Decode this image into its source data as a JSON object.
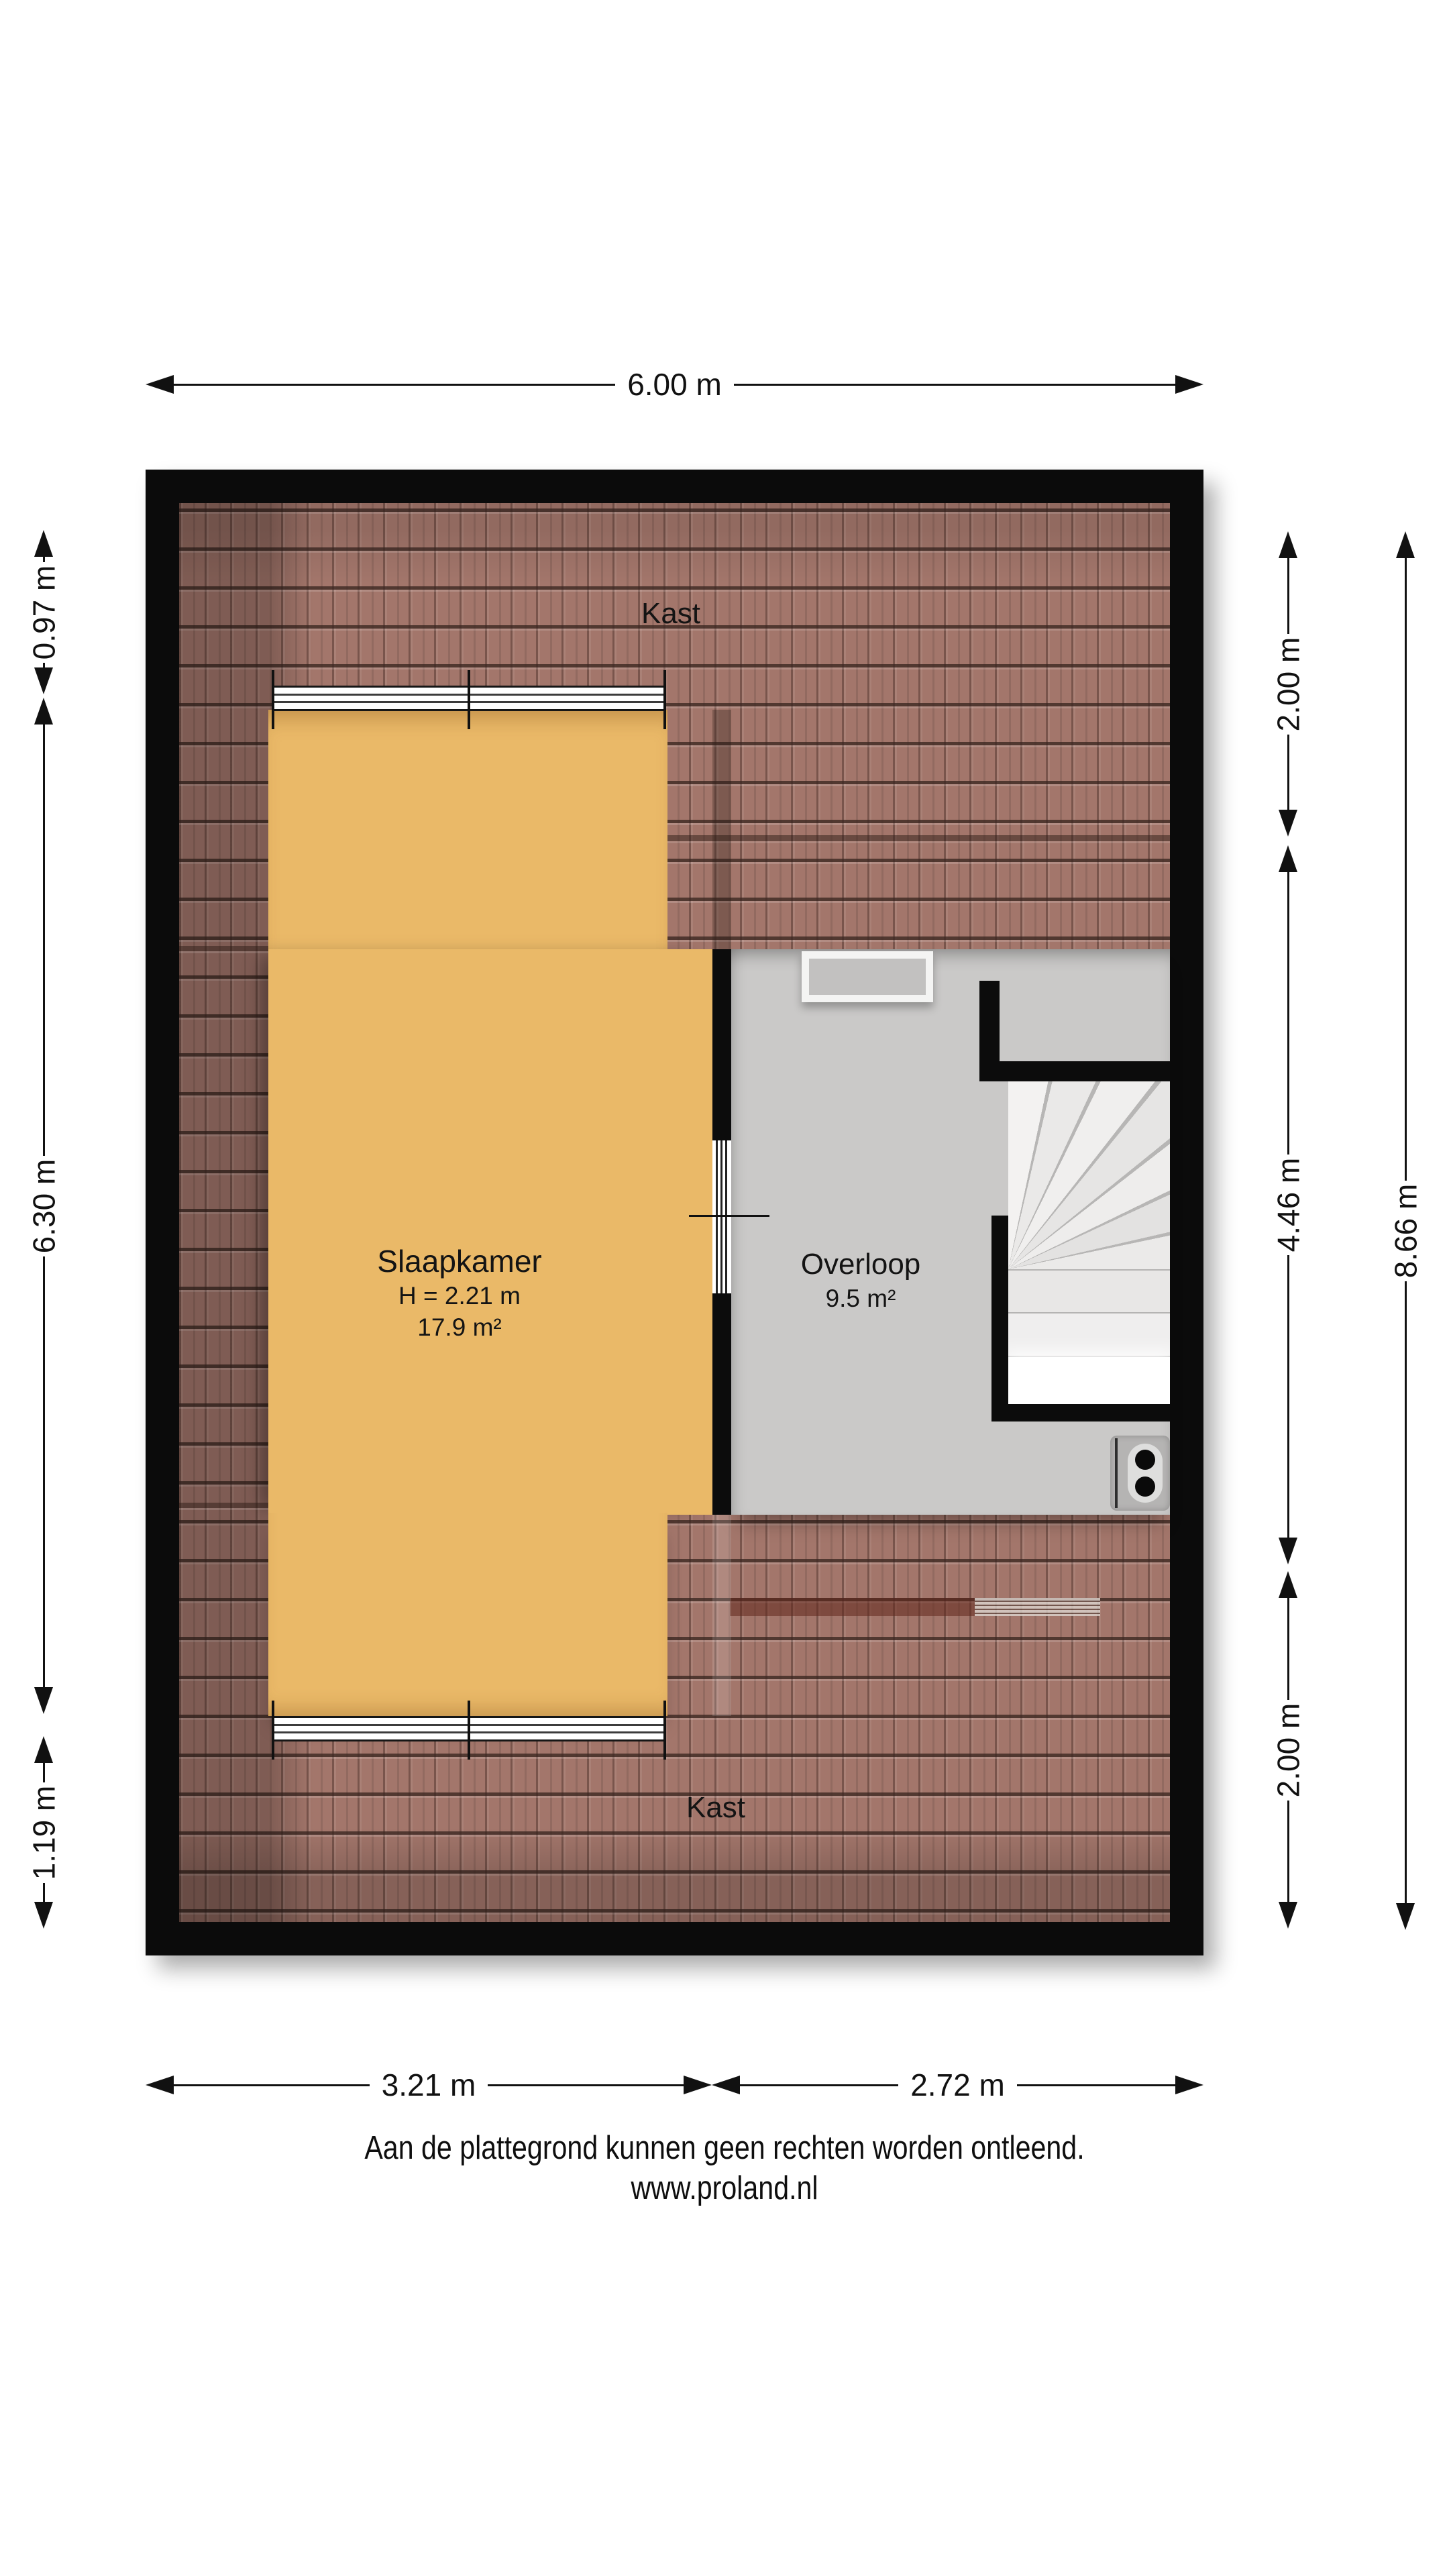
{
  "plan": {
    "rooms": {
      "kast_top": {
        "label": "Kast"
      },
      "slaapkamer": {
        "label": "Slaapkamer",
        "ceiling_height": "H = 2.21 m",
        "area": "17.9 m²"
      },
      "overloop": {
        "label": "Overloop",
        "area": "9.5 m²"
      },
      "kast_bottom": {
        "label": "Kast"
      }
    }
  },
  "dimensions": {
    "top": "6.00 m",
    "left": [
      "0.97 m",
      "6.30 m",
      "1.19 m"
    ],
    "right_inner": [
      "2.00 m",
      "4.46 m",
      "2.00 m"
    ],
    "right_outer": "8.66 m",
    "bottom": [
      "3.21 m",
      "2.72 m"
    ]
  },
  "footer": {
    "disclaimer": "Aan de plattegrond kunnen geen rechten worden ontleend.",
    "website": "www.proland.nl"
  },
  "colors": {
    "wall": "#0b0b0b",
    "roof": "#a3766b",
    "bedroom_floor": "#eab968",
    "overloop_floor": "#cac9c8"
  }
}
